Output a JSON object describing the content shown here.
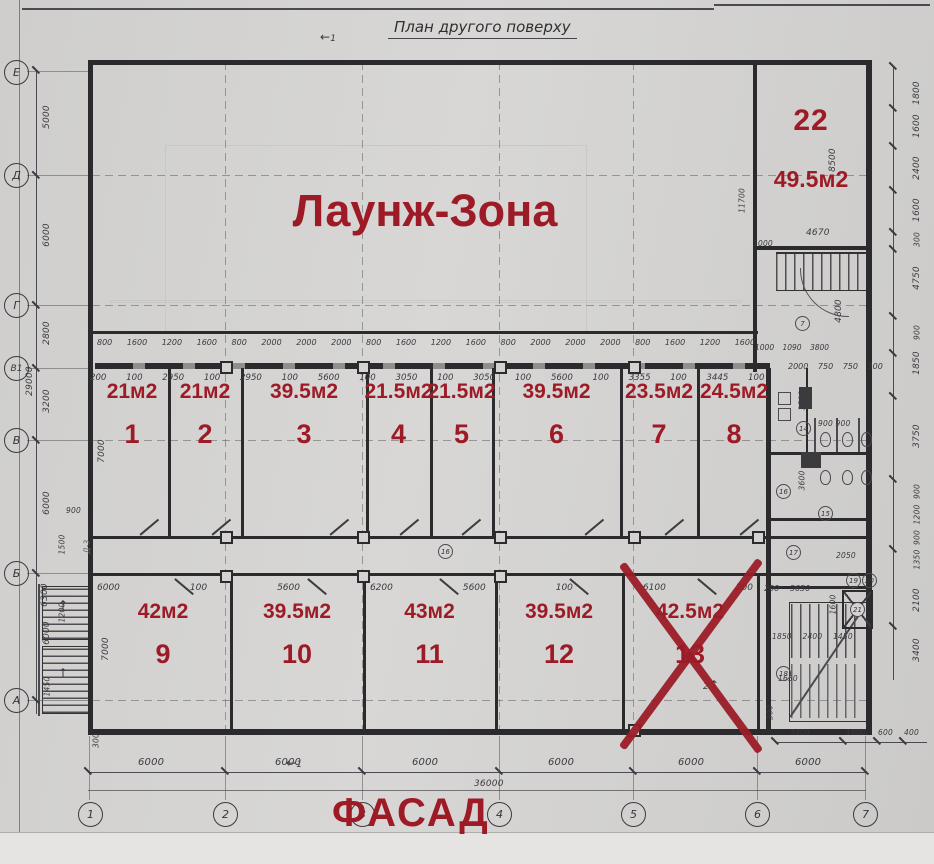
{
  "title": "План другого поверху",
  "annotation_color": "#9d1b26",
  "annotations": {
    "lounge_label": "Лаунж-Зона",
    "facade_label": "ФАСАД",
    "room22": {
      "number": "22",
      "area": "49.5м2"
    }
  },
  "rooms_middle": [
    {
      "number": "1",
      "area": "21м2"
    },
    {
      "number": "2",
      "area": "21м2"
    },
    {
      "number": "3",
      "area": "39.5м2"
    },
    {
      "number": "4",
      "area": "21.5м2"
    },
    {
      "number": "5",
      "area": "21.5м2"
    },
    {
      "number": "6",
      "area": "39.5м2"
    },
    {
      "number": "7",
      "area": "23.5м2"
    },
    {
      "number": "8",
      "area": "24.5м2"
    }
  ],
  "rooms_bottom": [
    {
      "number": "9",
      "area": "42м2"
    },
    {
      "number": "10",
      "area": "39.5м2"
    },
    {
      "number": "11",
      "area": "43м2"
    },
    {
      "number": "12",
      "area": "39.5м2"
    },
    {
      "number": "13",
      "area": "42.5м2",
      "crossed_out": true
    }
  ],
  "axes": {
    "bottom": [
      "1",
      "2",
      "3",
      "4",
      "5",
      "6",
      "7"
    ],
    "left": [
      "Е",
      "Д",
      "Г",
      "В1",
      "В",
      "Б",
      "А"
    ]
  },
  "dims": {
    "bottom": [
      "6000",
      "6000",
      "6000",
      "6000",
      "6000",
      "6000"
    ],
    "bottom_total": "36000",
    "left": [
      "5000",
      "6000",
      "2800",
      "3200",
      "6000",
      "6000",
      "1450"
    ],
    "left_total": "29000",
    "left_extra": {
      "v6300": "6300",
      "v900": "900",
      "v1500": "1500",
      "v1200": "1200",
      "v7000a": "7000",
      "v7000b": "7000",
      "v300": "300"
    },
    "right": [
      "1800",
      "1600",
      "2400",
      "1600",
      "300",
      "4750",
      "900",
      "1850",
      "3750",
      "900",
      "1200",
      "900",
      "1350",
      "2100",
      "3400"
    ],
    "annex": [
      "3400",
      "1600",
      "600",
      "400"
    ],
    "annex_side": "300",
    "rows": {
      "windows": "800 1600 1200 1600 800 2000 2000 2000 800 1600 1200 1600 800 2000 2000 2000 800 1600 1200 1600 500 1000",
      "room_widths": "200 100 2950 100 2950 100 5600 100 3050 100 3050 100 5600 100 3355 100 3445 100 1400",
      "right_top": "2000 750 750 300",
      "bottom_rooms": [
        "6000",
        "100",
        "5600",
        "6200",
        "5600",
        "100",
        "6100",
        "200"
      ],
      "right_mid": "200 3650",
      "vestibule": "1000 1090 3800"
    },
    "r22": {
      "height": "8500",
      "width": "4670",
      "left_height": "11700",
      "v1000": "1000",
      "hall_height": "4800"
    },
    "svc": {
      "a": "3500",
      "b": "900 900",
      "c": "3600",
      "e": "2050",
      "f": "1600",
      "g": "1850 2400 1450",
      "h": "1650"
    }
  },
  "circled": {
    "hall": "7",
    "svc_a": "14",
    "svc_b": "15",
    "svc_c": "16",
    "corridor": "16",
    "stair_top": "17",
    "stair": "18",
    "wc_a": "19",
    "wc_b": "20",
    "lift": "21"
  },
  "section_marks": {
    "s1": "1",
    "s2": "2"
  },
  "notes": {
    "stair": "Д-3"
  },
  "icons": {
    "up_arrow": "↑",
    "left_arrow": "←"
  }
}
